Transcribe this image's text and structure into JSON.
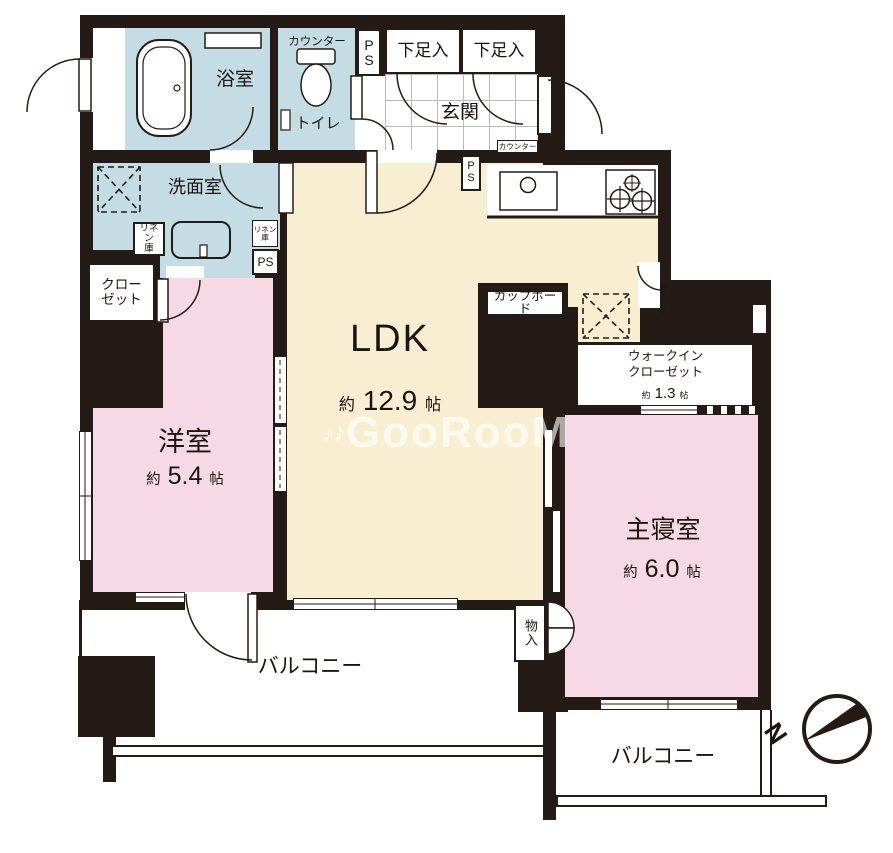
{
  "plan": {
    "rooms": {
      "bath": {
        "name": "浴室"
      },
      "toilet": {
        "name": "トイレ",
        "counter": "カウンター"
      },
      "washroom": {
        "name": "洗面室"
      },
      "genkan": {
        "name": "玄関",
        "counter_small": "カウンター"
      },
      "shoe": {
        "name": "下足入"
      },
      "ldk": {
        "name": "LDK",
        "approx": "約",
        "size": "12.9",
        "unit": "帖"
      },
      "yoshitsu": {
        "name": "洋室",
        "approx": "約",
        "size": "5.4",
        "unit": "帖"
      },
      "bedroom": {
        "name": "主寝室",
        "approx": "約",
        "size": "6.0",
        "unit": "帖"
      },
      "wic": {
        "line1": "ウォークイン",
        "line2": "クローゼット",
        "approx": "約",
        "size": "1.3",
        "unit": "帖"
      },
      "closet": {
        "line1": "クロー",
        "line2": "ゼット"
      },
      "cupboard": {
        "name": "カップボード"
      },
      "pantry": {
        "name": "パントリー"
      },
      "storage": {
        "name": "物入"
      },
      "balcony_left": {
        "name": "バルコニー"
      },
      "balcony_right": {
        "name": "バルコニー"
      },
      "linen": {
        "line1": "リネン",
        "line2": "庫"
      }
    },
    "ps": {
      "p": "P",
      "s": "S",
      "text": "PS"
    },
    "compass": {
      "north": "N"
    },
    "watermark": {
      "icon": "♪♪",
      "text": "GooRooM"
    },
    "colors": {
      "wall": "#251b16",
      "wet_area": "#c4dce4",
      "ldk": "#f8efd3",
      "bedroom": "#f6d9e5"
    }
  }
}
